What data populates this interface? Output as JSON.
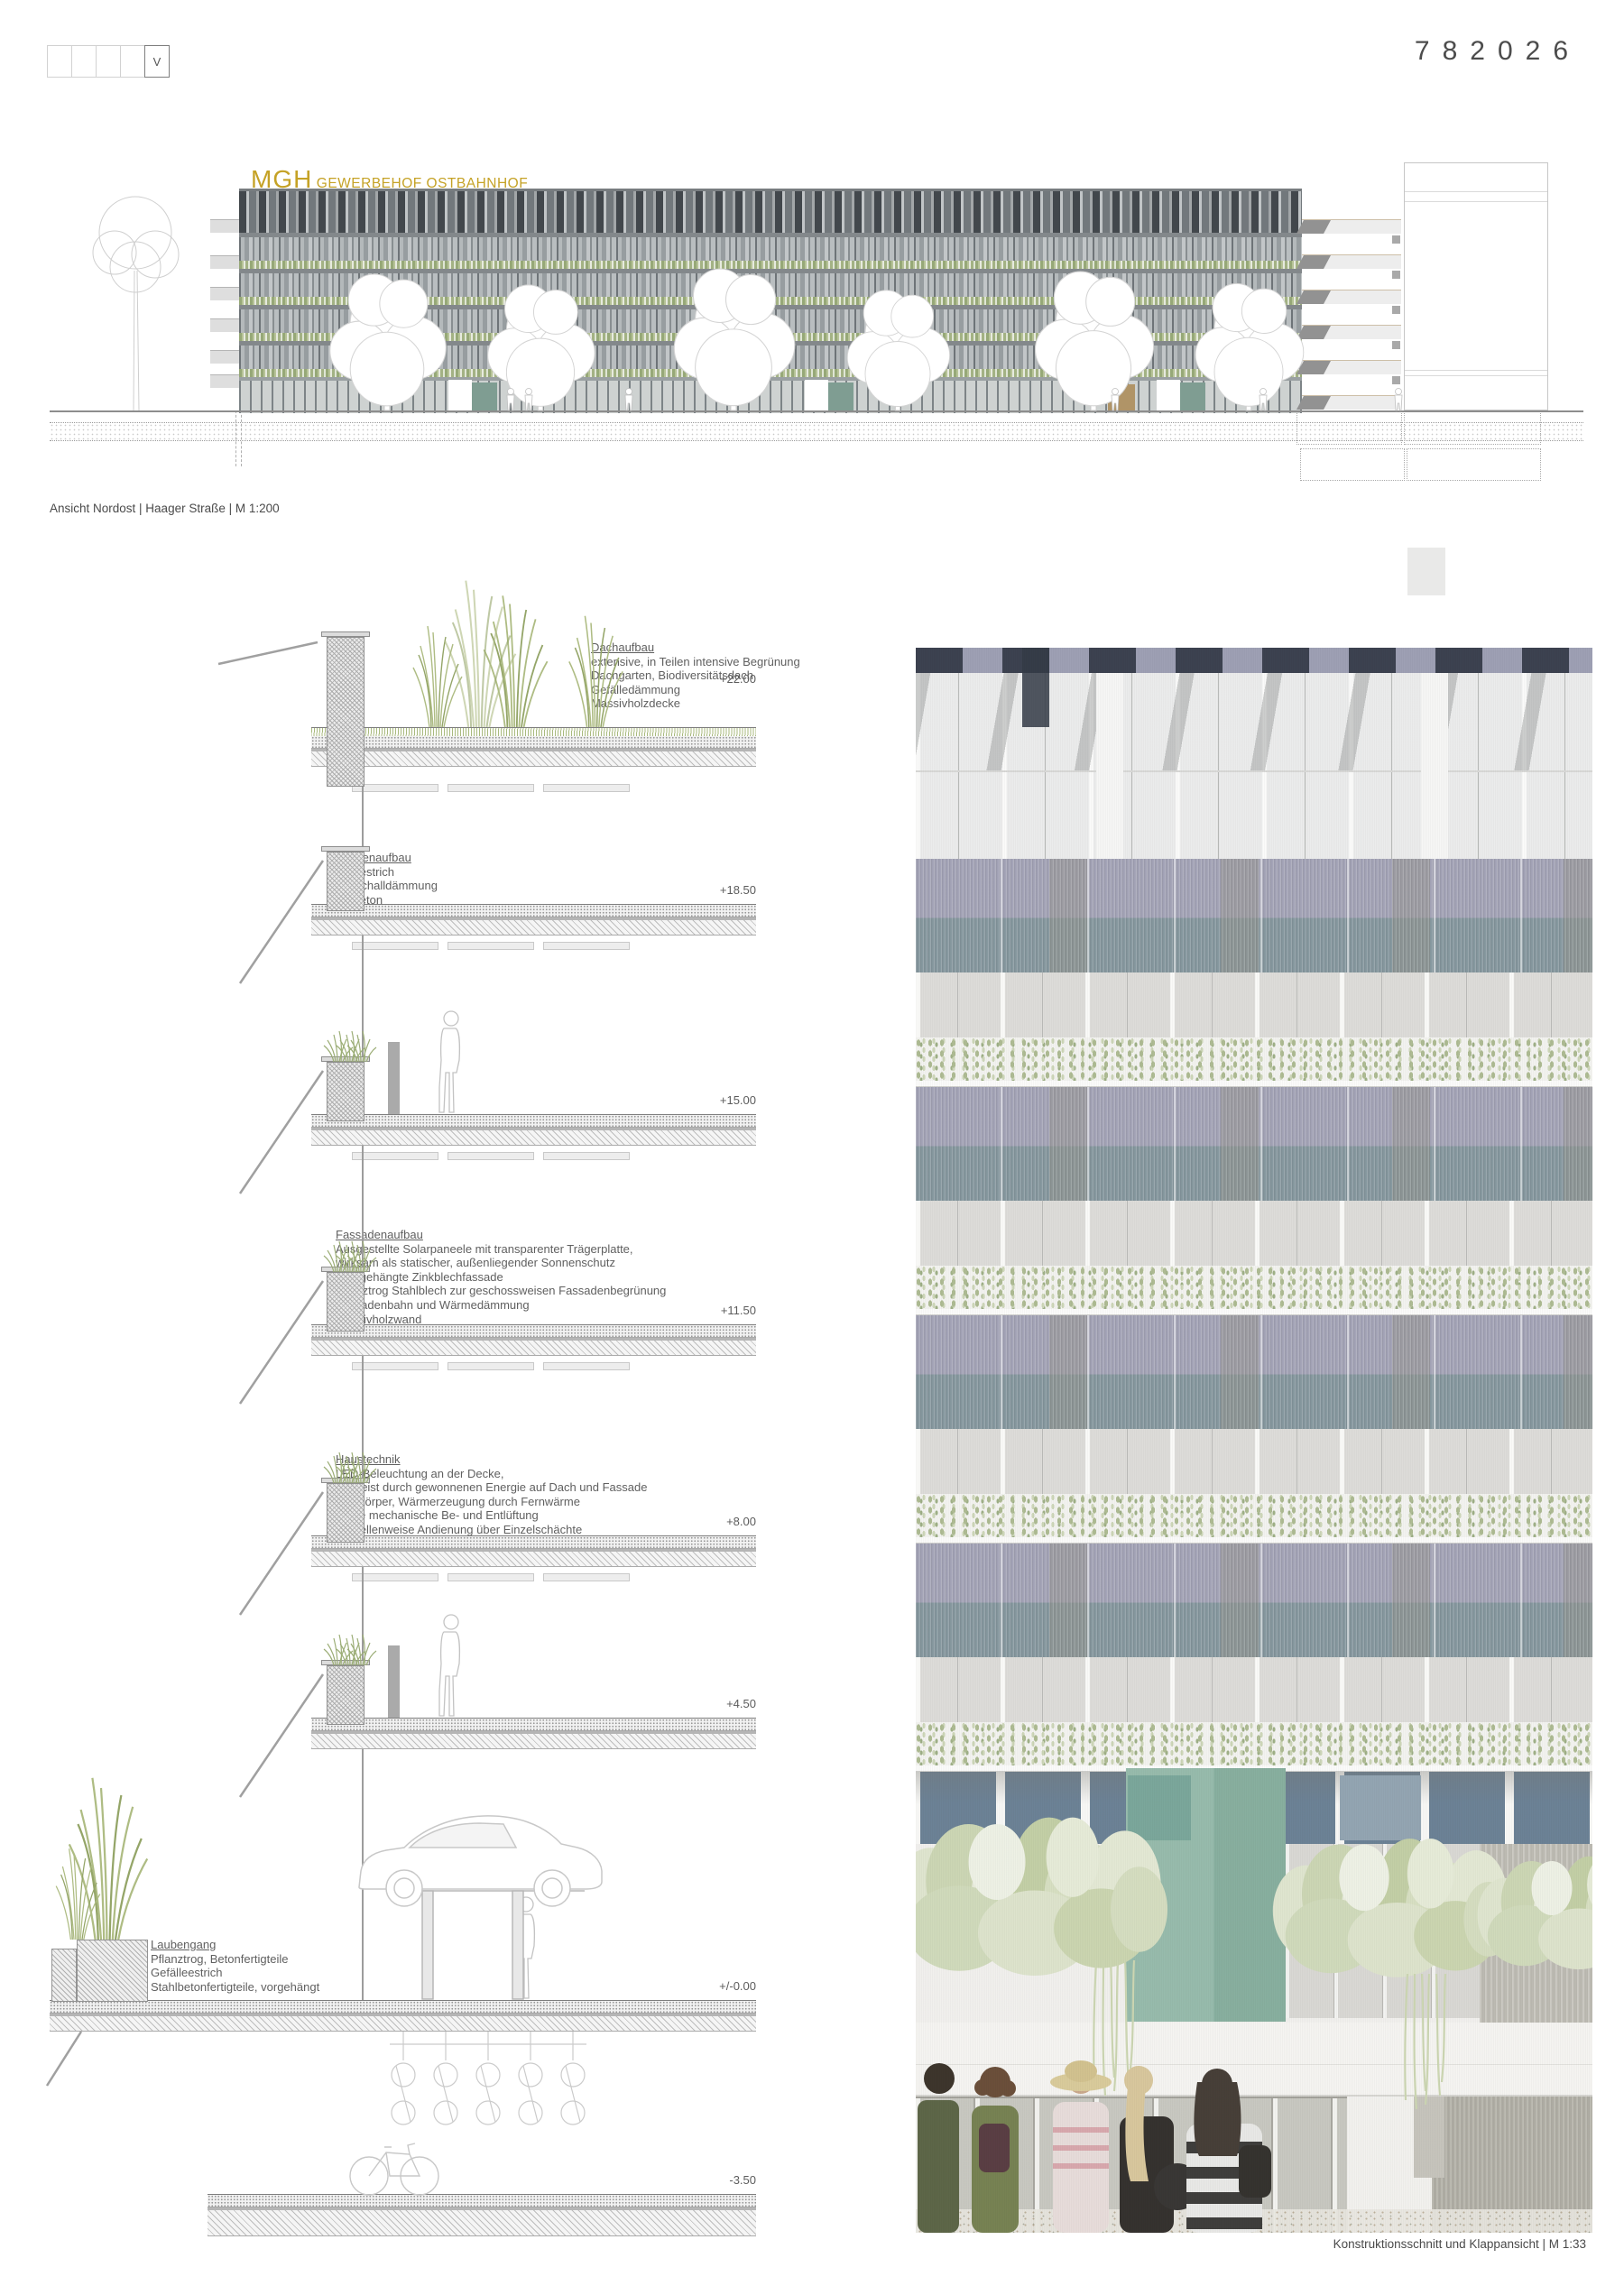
{
  "sheet": {
    "number": "782026",
    "revision": "V"
  },
  "project": {
    "name": "MGH",
    "subtitle": "GEWERBEHOF OSTBAHNHOF"
  },
  "captions": {
    "elevation": "Ansicht Nordost | Haager Straße | M 1:200",
    "section": "Konstruktionsschnitt und Klappansicht | M 1:33"
  },
  "levels": [
    "+22.00",
    "+18.50",
    "+15.00",
    "+11.50",
    "+8.00",
    "+4.50",
    "+/-0.00",
    "-3.50"
  ],
  "annotations": {
    "dachaufbau": {
      "title": "Dachaufbau",
      "lines": [
        "extensive, in Teilen intensive Begrünung",
        "Dachgarten, Biodiversitätsdach",
        "Gefälledämmung",
        "Massivholzdecke"
      ]
    },
    "deckenaufbau": {
      "title": "Deckenaufbau",
      "lines": [
        "Nutzestrich",
        "Trittschalldämmung",
        "Aufbeton",
        "Massivholzdecke"
      ]
    },
    "fassadenaufbau": {
      "title": "Fassadenaufbau",
      "lines": [
        "Ausgestellte Solarpaneele mit transparenter Trägerplatte,",
        "wirksam als statischer, außenliegender Sonnenschutz",
        "Vorhgehängte Zinkblechfassade",
        "Pflanztrog Stahlblech zur geschossweisen Fassadenbegrünung",
        "Fassadenbahn und Wärmedämmung",
        "Massivholzwand",
        "Holz-Aluminium-Fenster, öffenbar"
      ]
    },
    "haustechnik": {
      "title": "Haustechnik",
      "lines": [
        "LED-Beleuchtung an der Decke,",
        "gespeist durch gewonnenen Energie auf Dach und Fassade",
        "Heizkörper, Wärmerzeugung durch Fernwärme",
        "Keine mechanische Be- und Entlüftung",
        "Parzellenweise Andienung über Einzelschächte"
      ]
    },
    "laubengang": {
      "title": "Laubengang",
      "lines": [
        "Pflanztrog, Betonfertigteile",
        "Gefälleestrich",
        "Stahlbetonfertigteile, vorgehängt"
      ]
    }
  },
  "colors": {
    "brand_gold": "#c5a226",
    "door_teal": "#7f9d92",
    "door_tan": "#b09467",
    "facade_lavender": "#a5a5b8",
    "facade_bluegreen": "#8799a0",
    "terrace_teal": "#93b7a8",
    "plant_green": "#aebb93"
  }
}
